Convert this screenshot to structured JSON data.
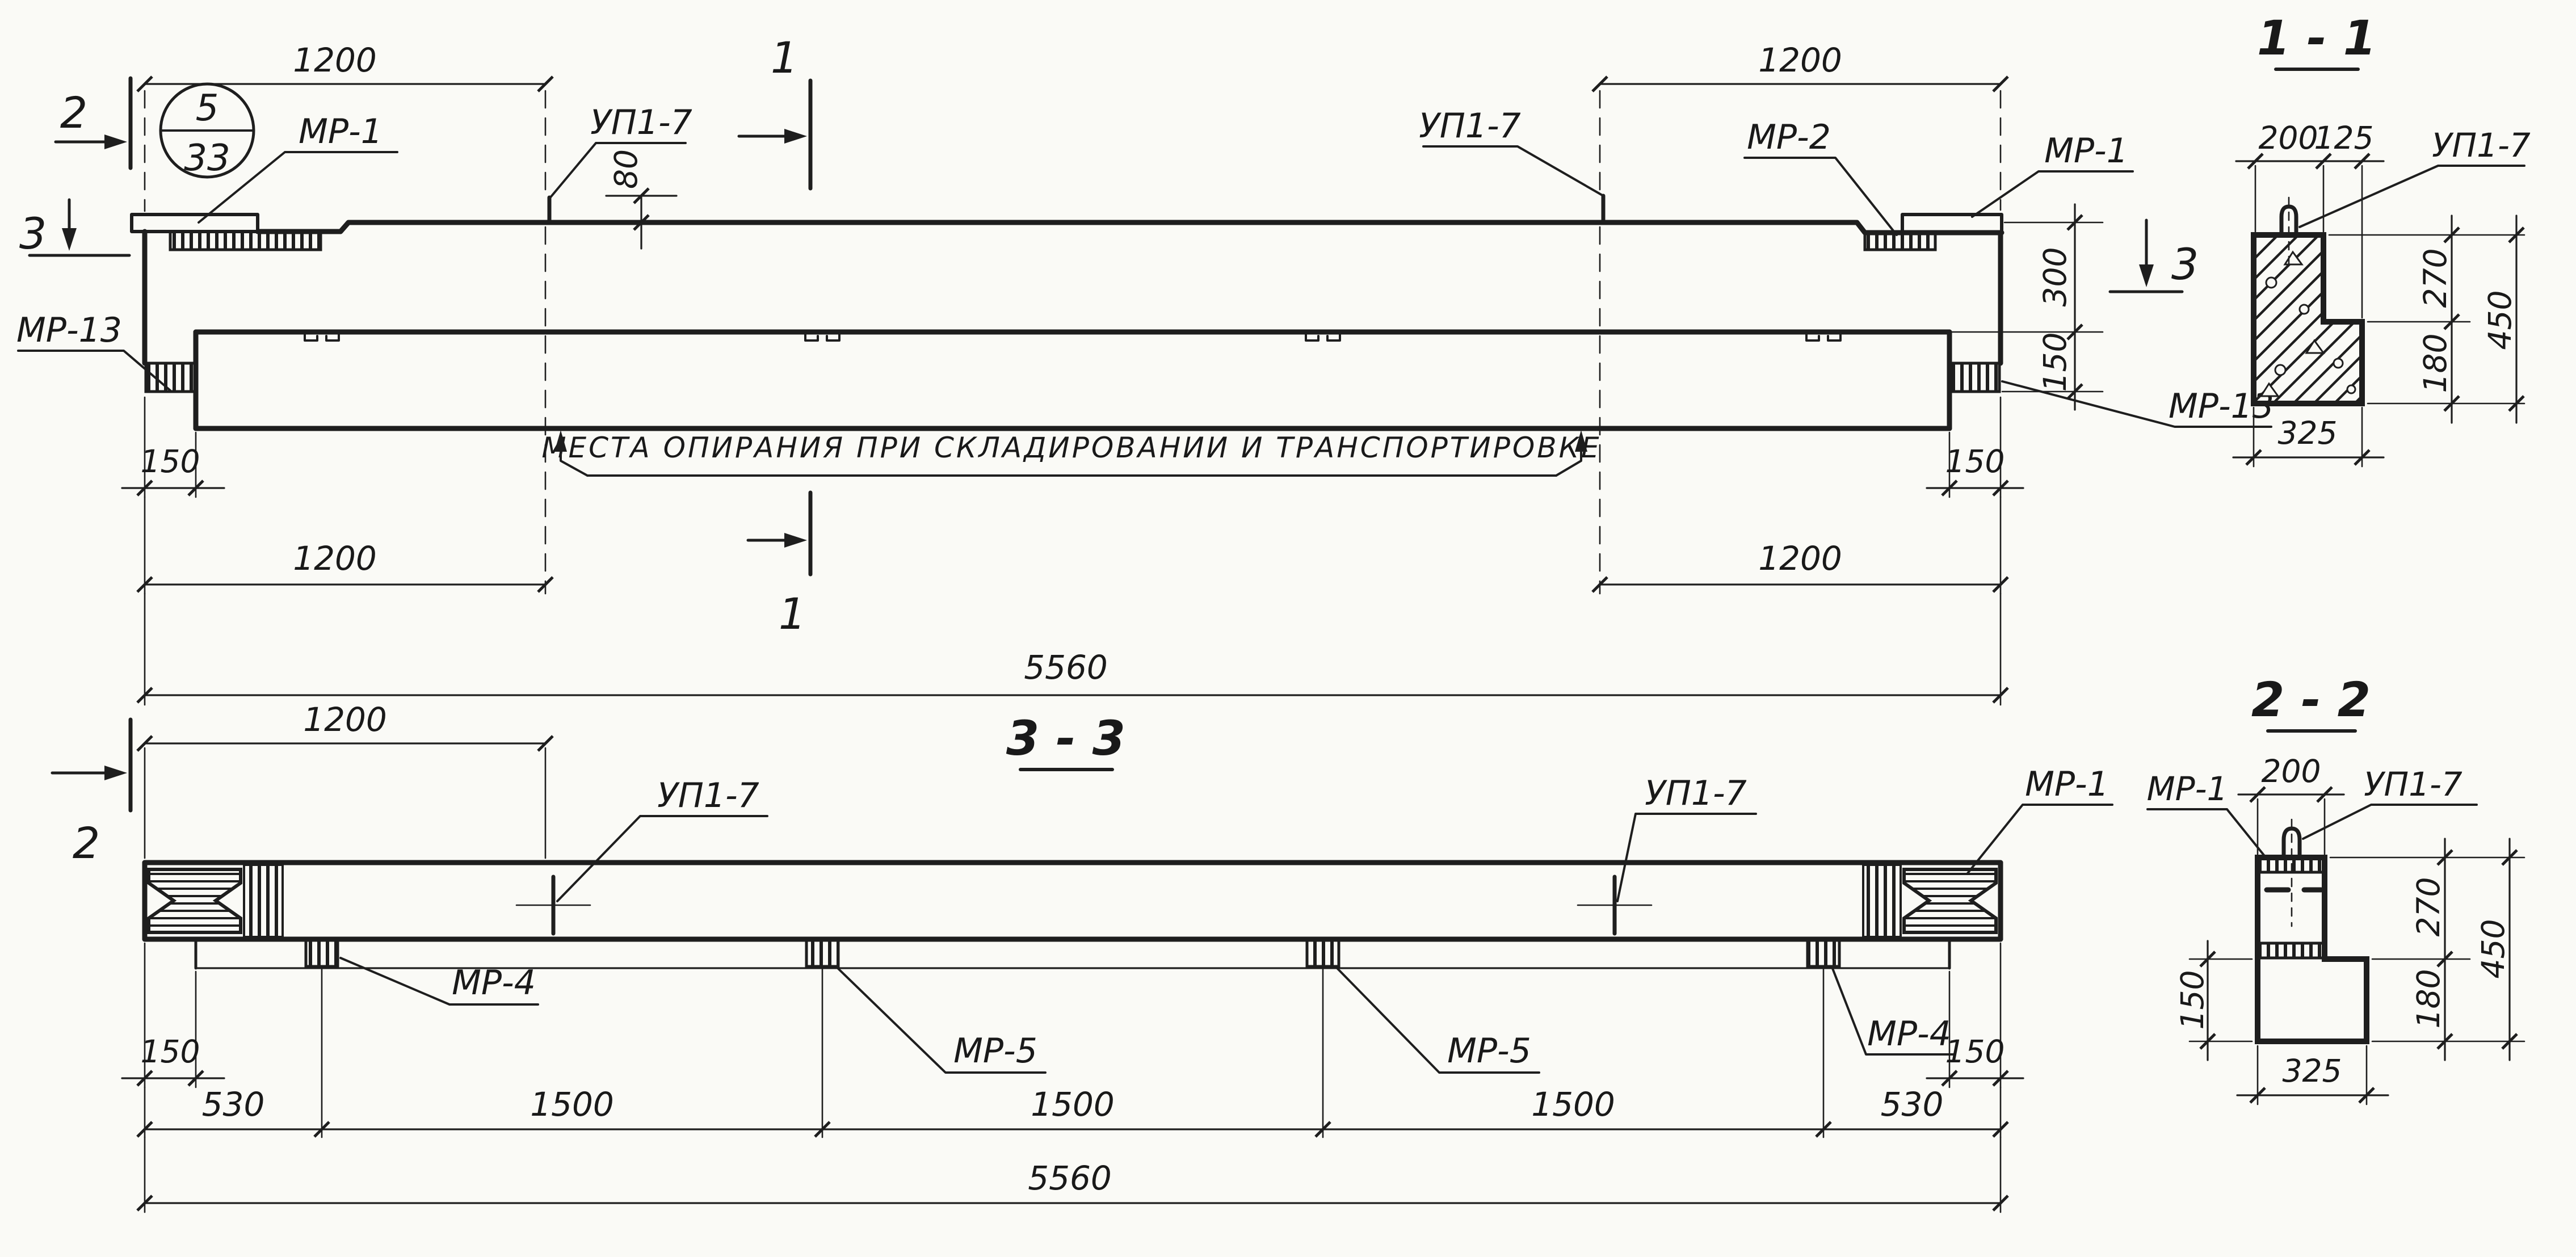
{
  "drawing": {
    "type": "reinforced-concrete beam shop drawing",
    "colors": {
      "ink": "#1e1e1e",
      "paper": "#fafaf6"
    }
  },
  "top_view": {
    "mark_circle": {
      "num": "5",
      "den": "33"
    },
    "labels": {
      "mr1_left": "МР-1",
      "up17_left": "УП1-7",
      "up17_right": "УП1-7",
      "mr2": "МР-2",
      "mr1_right": "МР-1",
      "mr13_left": "МР-13",
      "mr13_right": "МР-13"
    },
    "note": "МЕСТА ОПИРАНИЯ ПРИ СКЛАДИРОВАНИИ И ТРАНСПОРТИРОВКЕ",
    "dims": {
      "top_left_1200": "1200",
      "top_right_1200": "1200",
      "hook_80": "80",
      "side_300": "300",
      "side_150": "150",
      "bottom_left_150": "150",
      "bottom_right_150": "150",
      "bottom_left_1200": "1200",
      "bottom_right_1200": "1200",
      "total_5560": "5560"
    },
    "section_markers": {
      "s1": "1",
      "s2": "2",
      "s3": "3"
    }
  },
  "bottom_view": {
    "title": "3 - 3",
    "labels": {
      "up17_left": "УП1-7",
      "up17_right": "УП1-7",
      "mr1": "МР-1",
      "mr4_left": "МР-4",
      "mr4_right": "МР-4",
      "mr5_left": "МР-5",
      "mr5_right": "МР-5"
    },
    "dims": {
      "top_left_1200": "1200",
      "left_150": "150",
      "right_150": "150",
      "c1_530": "530",
      "c2_1500": "1500",
      "c3_1500": "1500",
      "c4_1500": "1500",
      "c5_530": "530",
      "total_5560": "5560"
    }
  },
  "section_1_1": {
    "title": "1 - 1",
    "label_up17": "УП1-7",
    "dims": {
      "w200": "200",
      "w125": "125",
      "h270": "270",
      "h450": "450",
      "h180": "180",
      "w325": "325"
    }
  },
  "section_2_2": {
    "title": "2 - 2",
    "labels": {
      "mr1": "МР-1",
      "up17": "УП1-7"
    },
    "dims": {
      "w200": "200",
      "h150": "150",
      "h270": "270",
      "h450": "450",
      "h180": "180",
      "w325": "325"
    }
  }
}
